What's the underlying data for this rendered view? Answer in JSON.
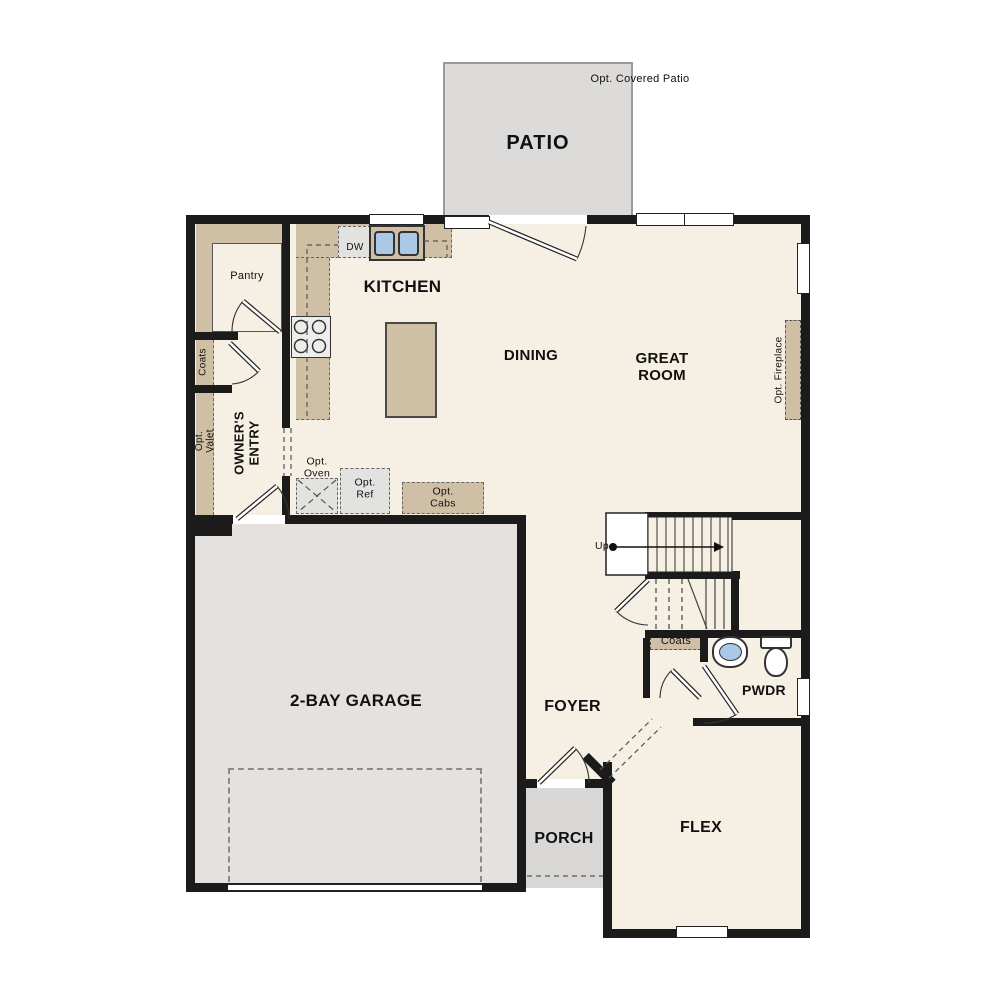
{
  "title": "First floor plan",
  "labels": {
    "patio_note": "Opt. Covered Patio",
    "patio": "PATIO",
    "pantry": "Pantry",
    "kitchen": "KITCHEN",
    "dw": "DW",
    "dining": "DINING",
    "great_room": "GREAT ROOM",
    "opt_fireplace": "Opt. Fireplace",
    "coats_entry": "Coats",
    "opt_valet": "Opt. Valet",
    "owners_entry": "OWNER'S ENTRY",
    "opt_oven": "Opt. Oven",
    "opt_ref": "Opt. Ref",
    "opt_cabs": "Opt. Cabs",
    "up": "Up",
    "coats_stairs": "Coats",
    "pwdr": "PWDR",
    "garage": "2-BAY GARAGE",
    "foyer": "FOYER",
    "porch": "PORCH",
    "flex": "FLEX"
  },
  "colors": {
    "floor_cream": "#f6efe3",
    "wall_black": "#1b1b1b",
    "cabinet_tan": "#cfc0a5",
    "patio_gray": "#dcdbd9",
    "garage_gray": "#e4e1de",
    "porch_gray": "#dad8d6",
    "appliance_gray": "#e2e2e0",
    "sink_blue": "#a9c9e6"
  }
}
